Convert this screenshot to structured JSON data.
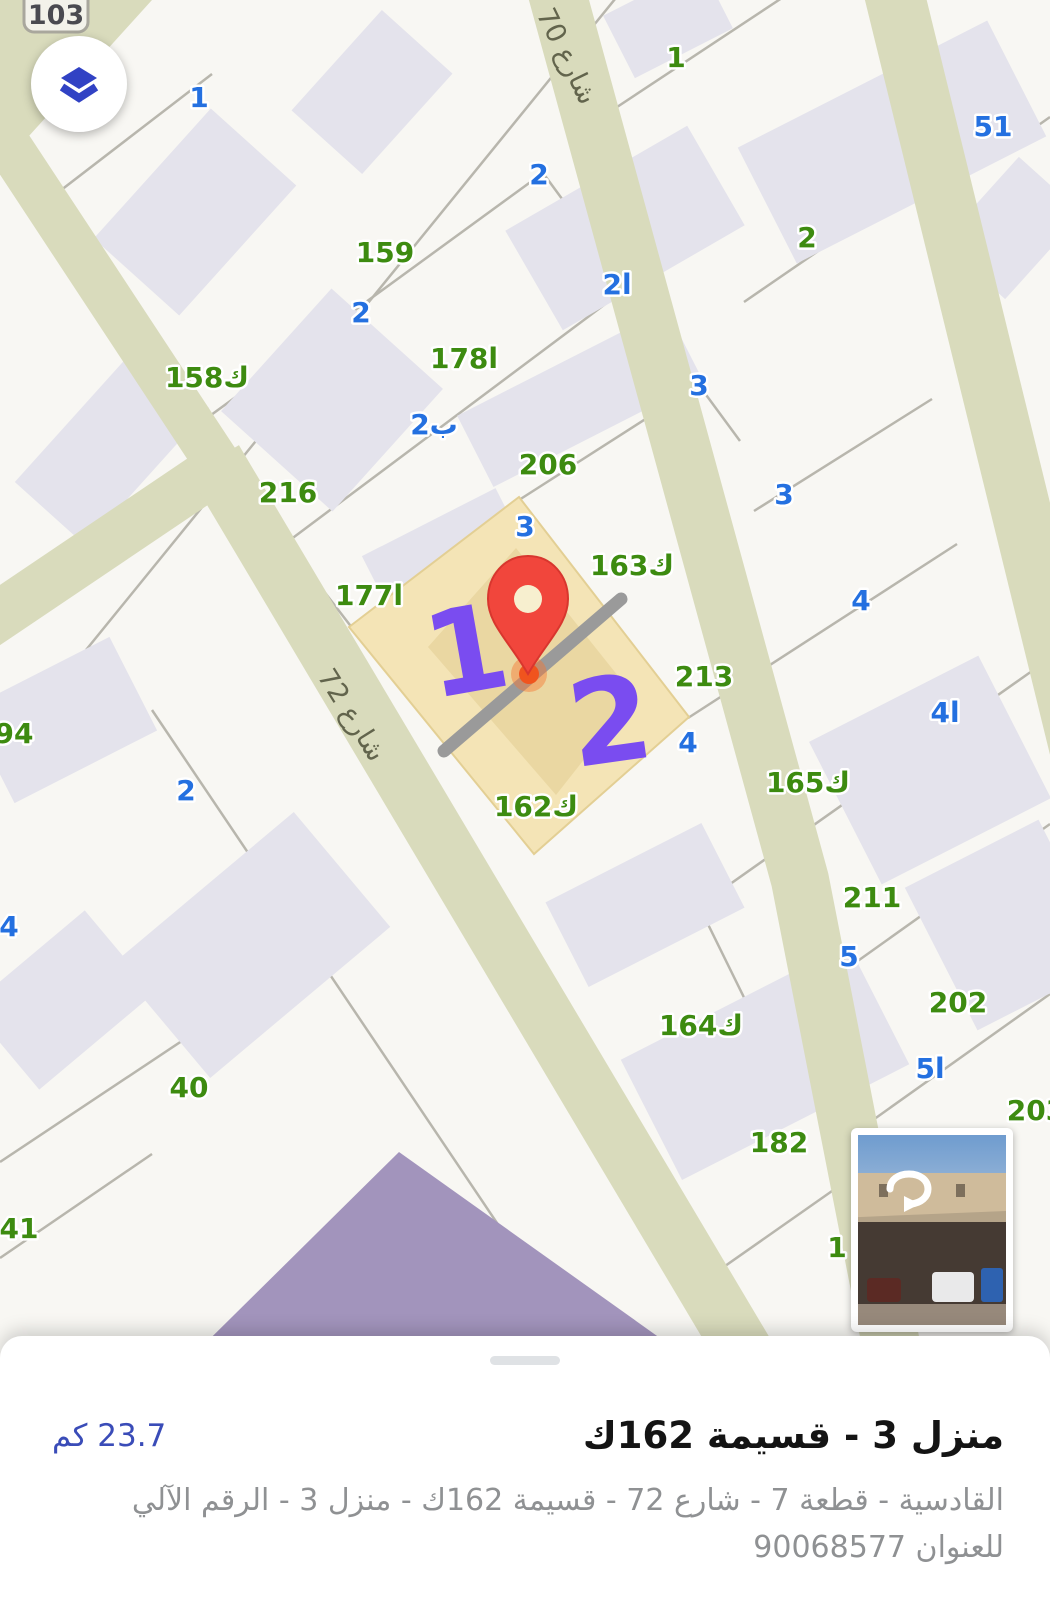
{
  "colors": {
    "accent_blue": "#3142c4",
    "label_green": "#3d8b10",
    "label_blue": "#2470e0",
    "road_fill": "#d9dbbc",
    "highlight_parcel_fill": "#f4e4b6",
    "pin_red": "#f1463c",
    "annotation_purple": "#7a4cf0",
    "distance_blue": "#3a4cb8",
    "purple_building": "#a294bc"
  },
  "map": {
    "route_shield": "103",
    "road_labels": [
      {
        "text": "شارع 70"
      },
      {
        "text": "شارع 72"
      }
    ],
    "annotations": [
      {
        "text": "1"
      },
      {
        "text": "2"
      }
    ],
    "parcel_labels": [
      {
        "text": "159",
        "x": 385,
        "y": 252,
        "color": "green"
      },
      {
        "text": "158ك",
        "x": 207,
        "y": 377,
        "color": "green"
      },
      {
        "text": "216",
        "x": 288,
        "y": 492,
        "color": "green"
      },
      {
        "text": "178ا",
        "x": 464,
        "y": 358,
        "color": "green"
      },
      {
        "text": "206",
        "x": 548,
        "y": 464,
        "color": "green"
      },
      {
        "text": "177ا",
        "x": 369,
        "y": 595,
        "color": "green"
      },
      {
        "text": "163ك",
        "x": 632,
        "y": 565,
        "color": "green"
      },
      {
        "text": "213",
        "x": 704,
        "y": 676,
        "color": "green"
      },
      {
        "text": "165ك",
        "x": 808,
        "y": 782,
        "color": "green"
      },
      {
        "text": "162ك",
        "x": 536,
        "y": 806,
        "color": "green"
      },
      {
        "text": "211",
        "x": 872,
        "y": 897,
        "color": "green"
      },
      {
        "text": "202",
        "x": 958,
        "y": 1002,
        "color": "green"
      },
      {
        "text": "164ك",
        "x": 701,
        "y": 1025,
        "color": "green"
      },
      {
        "text": "182",
        "x": 779,
        "y": 1142,
        "color": "green"
      },
      {
        "text": "203",
        "x": 1036,
        "y": 1110,
        "color": "green"
      },
      {
        "text": "94",
        "x": 14,
        "y": 733,
        "color": "green"
      },
      {
        "text": "40",
        "x": 189,
        "y": 1087,
        "color": "green"
      },
      {
        "text": "41",
        "x": 19,
        "y": 1228,
        "color": "green"
      },
      {
        "text": "1",
        "x": 676,
        "y": 57,
        "color": "green"
      },
      {
        "text": "2",
        "x": 807,
        "y": 237,
        "color": "green"
      },
      {
        "text": "1",
        "x": 837,
        "y": 1247,
        "color": "green"
      },
      {
        "text": "1",
        "x": 199,
        "y": 97,
        "color": "blue"
      },
      {
        "text": "2",
        "x": 539,
        "y": 174,
        "color": "blue"
      },
      {
        "text": "2ا",
        "x": 617,
        "y": 284,
        "color": "blue"
      },
      {
        "text": "2",
        "x": 361,
        "y": 312,
        "color": "blue"
      },
      {
        "text": "2ب",
        "x": 434,
        "y": 424,
        "color": "blue"
      },
      {
        "text": "3",
        "x": 699,
        "y": 385,
        "color": "blue"
      },
      {
        "text": "3",
        "x": 784,
        "y": 494,
        "color": "blue"
      },
      {
        "text": "3",
        "x": 525,
        "y": 526,
        "color": "blue"
      },
      {
        "text": "4",
        "x": 861,
        "y": 600,
        "color": "blue"
      },
      {
        "text": "4ا",
        "x": 945,
        "y": 712,
        "color": "blue"
      },
      {
        "text": "4",
        "x": 688,
        "y": 742,
        "color": "blue"
      },
      {
        "text": "51",
        "x": 993,
        "y": 126,
        "color": "blue"
      },
      {
        "text": "2",
        "x": 186,
        "y": 790,
        "color": "blue"
      },
      {
        "text": "4",
        "x": 9,
        "y": 926,
        "color": "blue"
      },
      {
        "text": "5",
        "x": 849,
        "y": 956,
        "color": "blue"
      },
      {
        "text": "5ا",
        "x": 930,
        "y": 1068,
        "color": "blue"
      }
    ]
  },
  "bottom_sheet": {
    "title": "منزل 3 - قسيمة 162ك",
    "distance": "23.7 كم",
    "address": "القادسية - قطعة 7 - شارع 72 - قسيمة 162ك - منزل 3 - الرقم الآلي للعنوان 90068577"
  }
}
